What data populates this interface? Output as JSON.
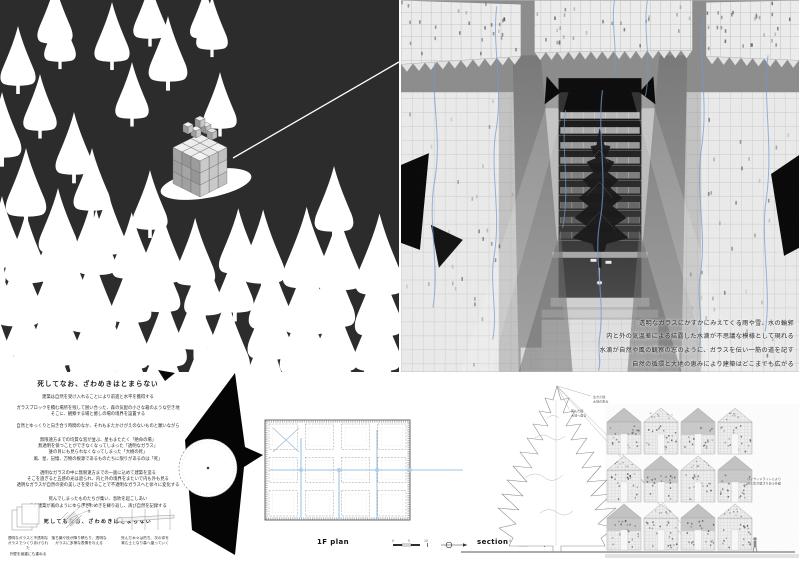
{
  "title_block": {
    "title": "死してなお、ざわめきはとまらない",
    "p1": "建築は自然を受け入れることにより前進と水平を獲得する",
    "p2a": "ガラスブロックを積む場所を残して囲い合った、森の気配の小さな箱のような空き地",
    "p2b": "そこに、観察する場と癒しの場の境界を設置する",
    "p3": "自然とゆっくりと向き合う時間のなか、それもまたかけがえのないものと願いながら",
    "b2a": "無限遠方までの均質な窓が並ぶ、星もまたたく「絶命の場」",
    "b2b": "無透明を保つことができなくなってしまった「透明なガラス」",
    "b2c": "誰の目にも見られなくなってしまった「大樹の死」",
    "b2d": "風、星、記憶、万物の根源であるものたちに限りがあるのは「死」",
    "b3a": "透明なガラスの中に無限遠方までの一面に込めて建築を造る",
    "b3b": "そこを過ぎると五感の光は遮られ、内と外の境界をまたいで内も外も見る",
    "b3c": "透明なガラスが自然の姿の美しさを受けることで不透明なガラスへと徐々に変化する",
    "b4a": "死んでしまったものたちが集い、息吹を起こしあい",
    "b4b": "この建築が風のようにゆらぎざわめきを繰り返し、再び自然を記録する",
    "closing": "死してもなお、ざわめきはとまらない"
  },
  "render_captions": [
    "透明なガラスにかすかにみえてくる雨や雪、水の輪郭",
    "内と外の気温差による結露した水滴が不思議な模様として現れる",
    "水滴が自然や風の観察の窓のように、ガラスを伝い一筋の道を記す",
    "自然の循環と大地の恵みにより建築はどこまでも広がる"
  ],
  "diagram_captions": {
    "d1a": "透明なガラスと不透明な",
    "d1b": "ガラスでつくりあげられた",
    "d1c": "外壁を幾重にも重ねる",
    "d2a": "落ち葉や枝が降り積もり、透明な",
    "d2b": "ガラスに多様な表情を与える",
    "d2n1": "落ち葉",
    "d2n2": "枝",
    "d3a": "死んだ木々は朽ち、次の命を",
    "d3b": "育む土となり森へ還っていく"
  },
  "plan": {
    "label": "1F plan"
  },
  "section": {
    "label": "section",
    "tree_note1a": "生きた樹",
    "tree_note1b": "大地の恵み",
    "tree_note2a": "死んだ樹",
    "tree_note2b": "大地へ還る",
    "houses_note1": "ハイサイドライトにより",
    "houses_note2": "光と影が混ざりあう外壁"
  },
  "scalebar": {
    "n0": "0",
    "n5": "5",
    "n10": "10"
  }
}
